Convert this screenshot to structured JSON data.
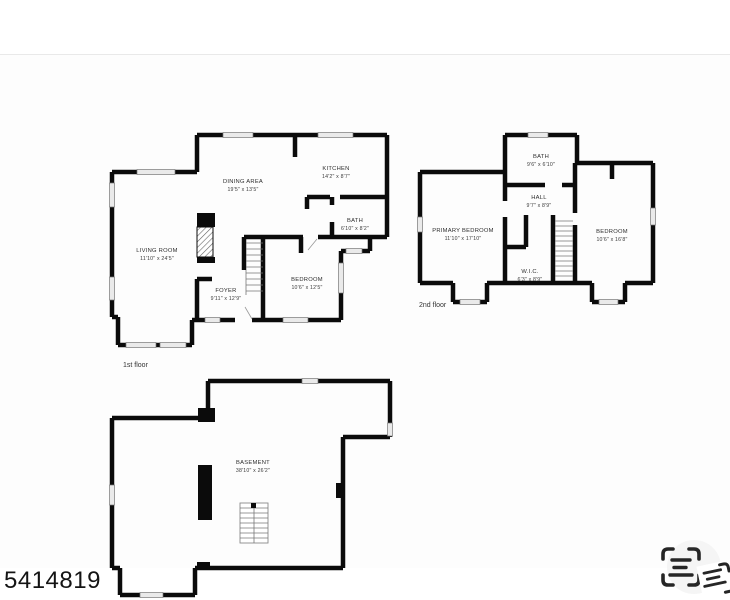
{
  "page": {
    "photo_id": "5414819",
    "background": "#ffffff"
  },
  "colors": {
    "wall": "#0b0b0b",
    "window_fill": "#eaeaea",
    "window_edge": "#777777",
    "room_label": "#2e2e2e",
    "icon": "#262626"
  },
  "icons": {
    "scan_text": "scan-text-icon"
  },
  "floors": {
    "first": {
      "label": "1st floor",
      "rooms": [
        {
          "name": "LIVING ROOM",
          "dims": "11'10\" x 24'5\""
        },
        {
          "name": "DINING AREA",
          "dims": "19'5\" x 13'5\""
        },
        {
          "name": "KITCHEN",
          "dims": "14'2\" x 8'7\""
        },
        {
          "name": "BATH",
          "dims": "6'10\" x 8'2\""
        },
        {
          "name": "BEDROOM",
          "dims": "10'6\" x 12'5\""
        },
        {
          "name": "FOYER",
          "dims": "9'11\" x 12'9\""
        }
      ]
    },
    "second": {
      "label": "2nd floor",
      "rooms": [
        {
          "name": "BATH",
          "dims": "9'6\" x 6'10\""
        },
        {
          "name": "HALL",
          "dims": "9'7\" x 8'9\""
        },
        {
          "name": "PRIMARY BEDROOM",
          "dims": "11'10\" x 17'10\""
        },
        {
          "name": "W.I.C.",
          "dims": "6'3\" x 8'9\""
        },
        {
          "name": "BEDROOM",
          "dims": "10'6\" x 16'8\""
        }
      ]
    },
    "basement": {
      "label": "Basement 1",
      "rooms": [
        {
          "name": "BASEMENT",
          "dims": "38'10\" x 26'2\""
        }
      ]
    }
  }
}
